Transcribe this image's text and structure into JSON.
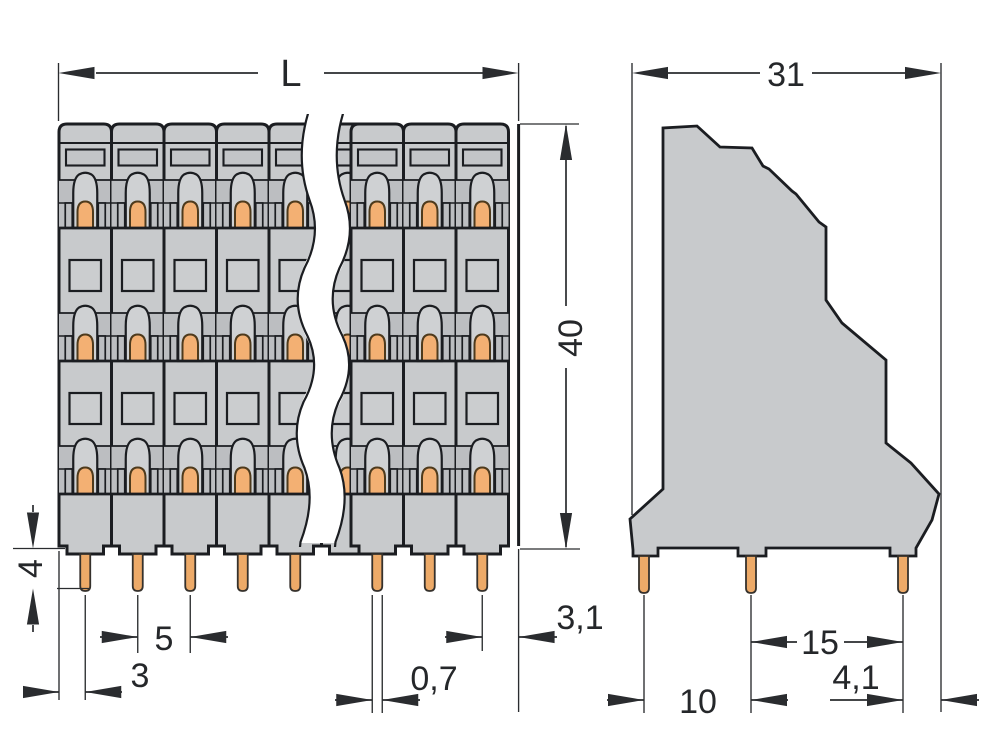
{
  "drawing": {
    "front_view": {
      "dims": {
        "length": "L",
        "height": "40",
        "pin_length": "4",
        "pin_pitch": "5",
        "edge_to_first_pin": "3",
        "pin_width": "0,7",
        "last_pin_to_edge": "3,1"
      }
    },
    "side_view": {
      "dims": {
        "depth": "31",
        "pin_row_span": "15",
        "front_pin_spacing": "10",
        "pin_to_edge": "4,1"
      }
    },
    "colors": {
      "housing_gray": "#c8cacc",
      "recess_gray": "#bcbec1",
      "clamp_gray": "#cfd1d3",
      "window_gray": "#cbcdcf",
      "conductor_orange": "#f3b073",
      "pin_orange": "#edaa68",
      "outline_dark": "#1b1d21",
      "dimension_dark": "#2a2c2f",
      "background": "#ffffff"
    }
  }
}
